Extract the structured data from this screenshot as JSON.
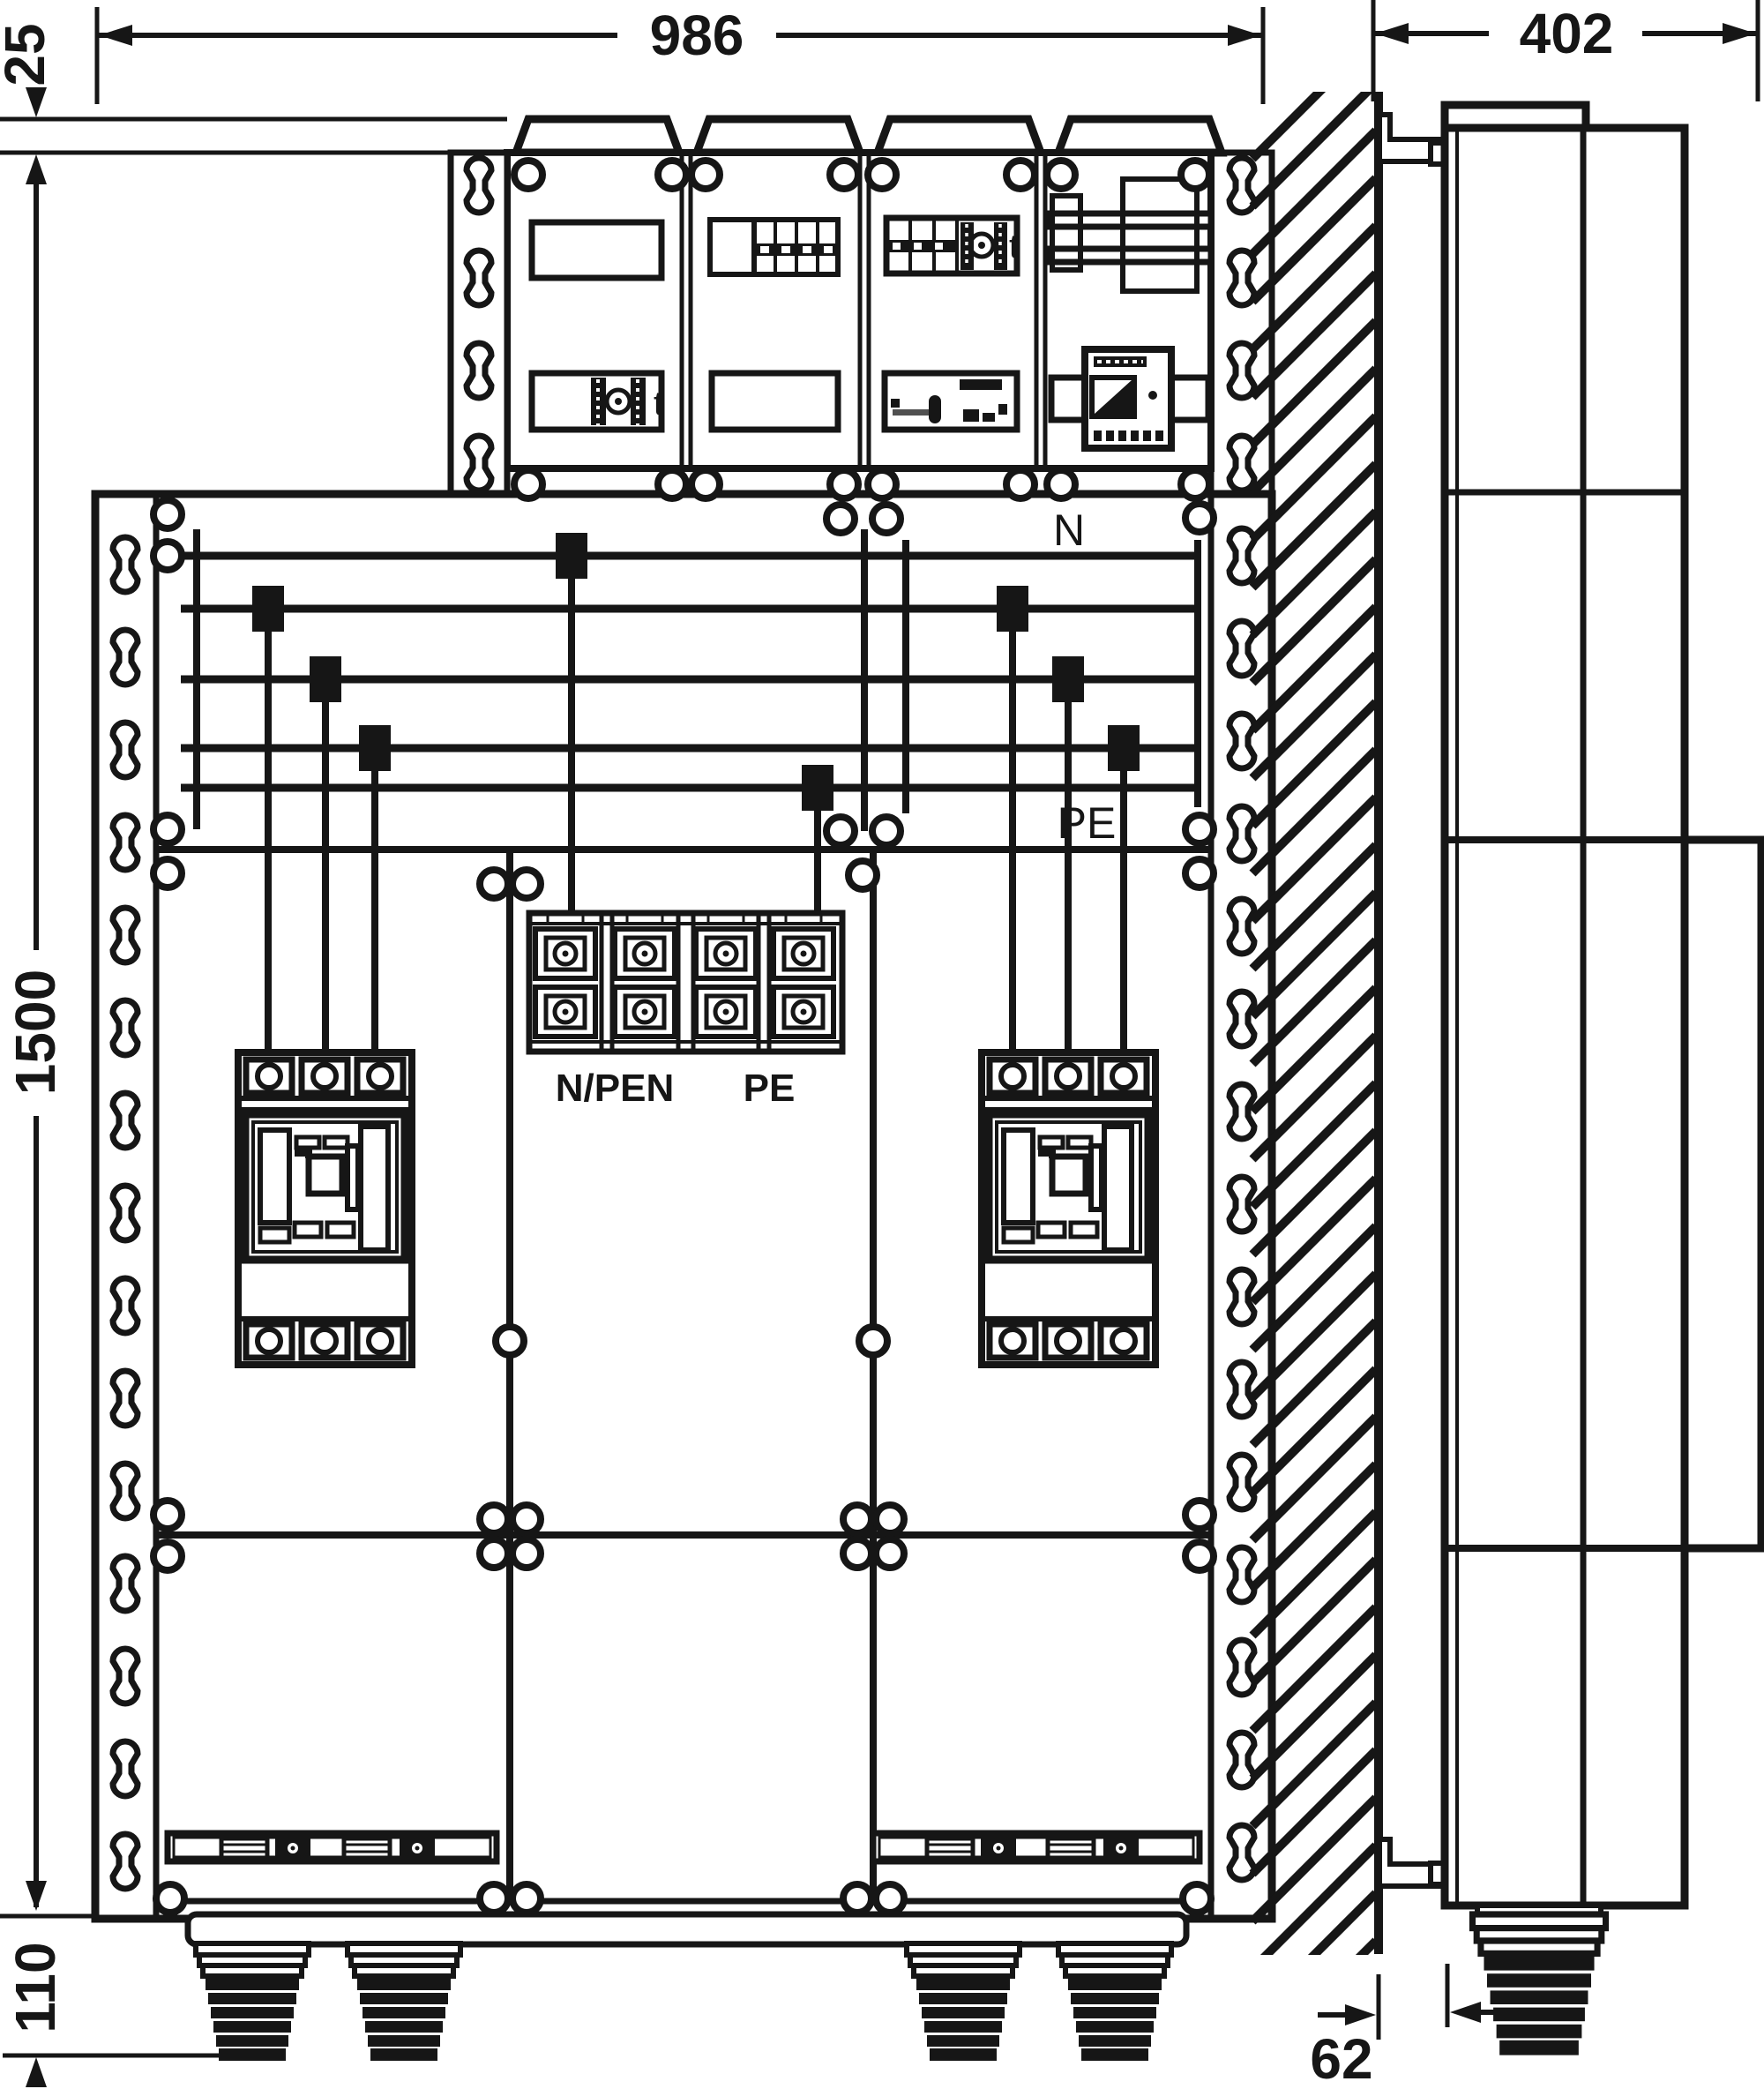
{
  "drawing": {
    "dims": {
      "overall_width": "986",
      "side_depth": "402",
      "top_offset": "25",
      "overall_height": "1500",
      "gland_drop": "110",
      "wall_clearance": "62"
    },
    "labels": {
      "n_bus": "N",
      "pe_bus": "PE",
      "npen_terminal": "N/PEN",
      "pe_terminal": "PE",
      "timer_a": "t",
      "timer_b": "t"
    },
    "colors": {
      "ink": "#161616",
      "paper": "#ffffff"
    }
  }
}
